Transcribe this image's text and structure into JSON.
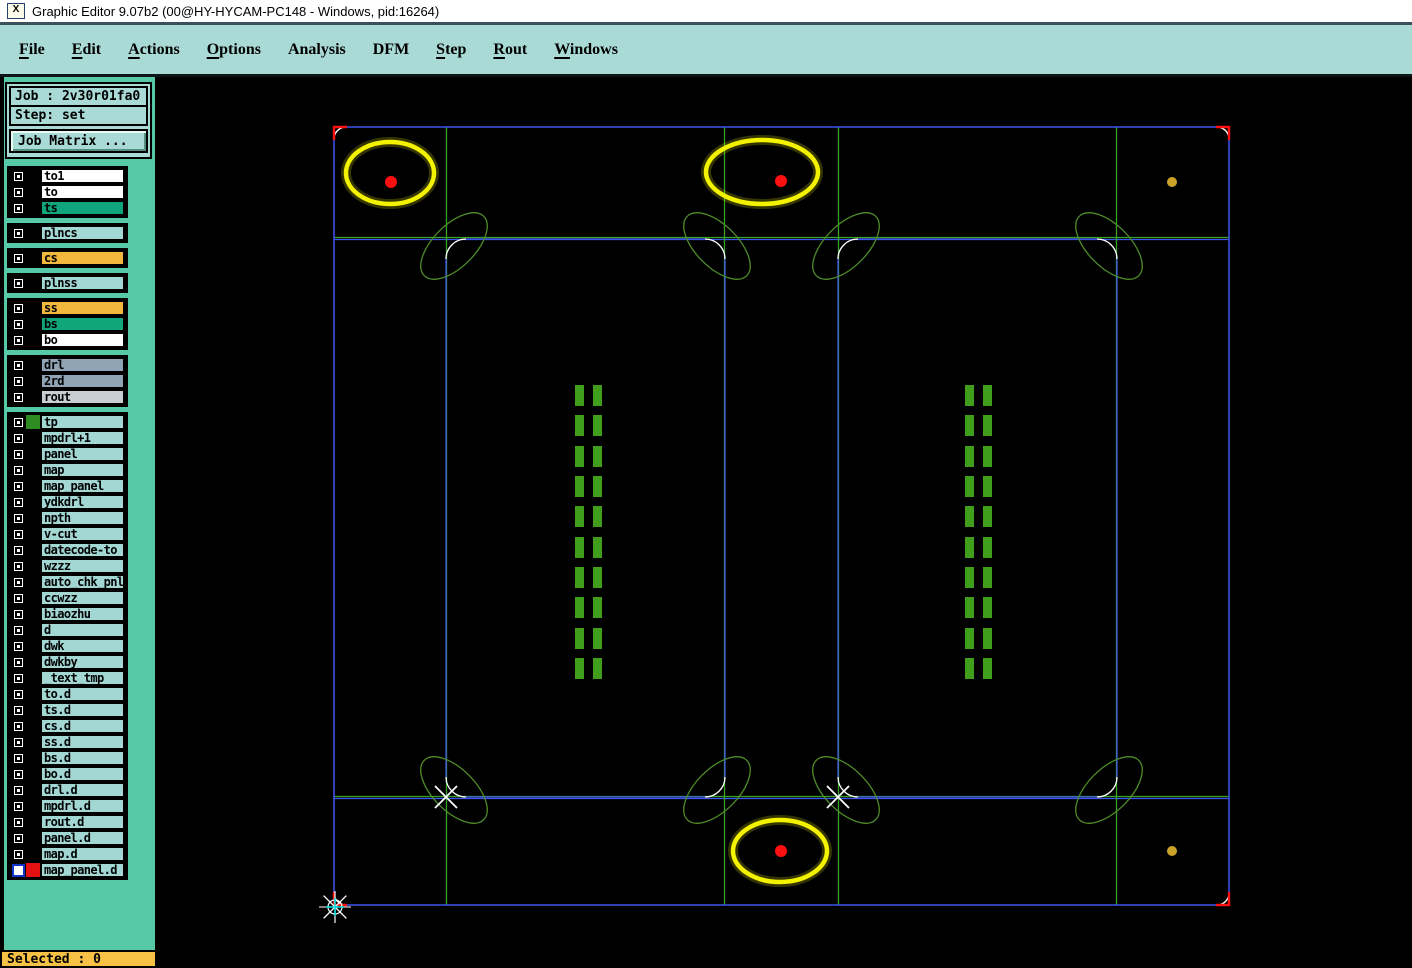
{
  "window": {
    "title": "Graphic Editor 9.07b2 (00@HY-HYCAM-PC148 - Windows, pid:16264)",
    "icon_glyph": "X"
  },
  "menu": {
    "items": [
      {
        "label": "File",
        "underline": 0
      },
      {
        "label": "Edit",
        "underline": 0
      },
      {
        "label": "Actions",
        "underline": 0
      },
      {
        "label": "Options",
        "underline": 0
      },
      {
        "label": "Analysis",
        "underline": -1
      },
      {
        "label": "DFM",
        "underline": -1
      },
      {
        "label": "Step",
        "underline": 0
      },
      {
        "label": "Rout",
        "underline": 0
      },
      {
        "label": "Windows",
        "underline": 0
      }
    ]
  },
  "sidebar": {
    "job_label": "Job : 2v30r01fa0",
    "step_label": "Step: set",
    "job_matrix_button": "Job Matrix ...",
    "selected_status": "Selected : 0",
    "row_colors": {
      "white": "#ffffff",
      "green": "#10a57b",
      "orange": "#f2b83e",
      "pale": "#a2d7d3",
      "gray": "#8fa3b5",
      "lightgray": "#c9ced2"
    },
    "layer_groups": [
      [
        {
          "label": "to1",
          "bg": "#ffffff"
        },
        {
          "label": "to",
          "bg": "#ffffff"
        },
        {
          "label": "ts",
          "bg": "#10a57b"
        }
      ],
      [
        {
          "label": "plncs",
          "bg": "#a2d7d3"
        }
      ],
      [
        {
          "label": "cs",
          "bg": "#f2b83e"
        }
      ],
      [
        {
          "label": "plnss",
          "bg": "#a2d7d3"
        }
      ],
      [
        {
          "label": "ss",
          "bg": "#f2b83e"
        },
        {
          "label": "bs",
          "bg": "#10a57b"
        },
        {
          "label": "bo",
          "bg": "#ffffff"
        }
      ],
      [
        {
          "label": "drl",
          "bg": "#8fa3b5"
        },
        {
          "label": "2rd",
          "bg": "#8fa3b5"
        },
        {
          "label": "rout",
          "bg": "#c9ced2"
        }
      ],
      [
        {
          "label": "tp",
          "bg": "#a2d7d3",
          "swatch": "#2e8b22"
        },
        {
          "label": "mpdrl+1",
          "bg": "#a2d7d3"
        },
        {
          "label": "panel",
          "bg": "#a2d7d3"
        },
        {
          "label": "map",
          "bg": "#a2d7d3"
        },
        {
          "label": "map_panel",
          "bg": "#a2d7d3"
        },
        {
          "label": "ydkdrl",
          "bg": "#a2d7d3"
        },
        {
          "label": "npth",
          "bg": "#a2d7d3"
        },
        {
          "label": "v-cut",
          "bg": "#a2d7d3"
        },
        {
          "label": "datecode-to",
          "bg": "#a2d7d3"
        },
        {
          "label": "wzzz",
          "bg": "#a2d7d3"
        },
        {
          "label": "auto_chk_pnl",
          "bg": "#a2d7d3"
        },
        {
          "label": "ccwzz",
          "bg": "#a2d7d3"
        },
        {
          "label": "biaozhu",
          "bg": "#a2d7d3"
        },
        {
          "label": "d",
          "bg": "#a2d7d3"
        },
        {
          "label": "dwk",
          "bg": "#a2d7d3"
        },
        {
          "label": "dwkby",
          "bg": "#a2d7d3"
        },
        {
          "label": "_text_tmp",
          "bg": "#a2d7d3"
        },
        {
          "label": "to.d",
          "bg": "#a2d7d3"
        },
        {
          "label": "ts.d",
          "bg": "#a2d7d3"
        },
        {
          "label": "cs.d",
          "bg": "#a2d7d3"
        },
        {
          "label": "ss.d",
          "bg": "#a2d7d3"
        },
        {
          "label": "bs.d",
          "bg": "#a2d7d3"
        },
        {
          "label": "bo.d",
          "bg": "#a2d7d3"
        },
        {
          "label": "drl.d",
          "bg": "#a2d7d3"
        },
        {
          "label": "mpdrl.d",
          "bg": "#a2d7d3"
        },
        {
          "label": "rout.d",
          "bg": "#a2d7d3"
        },
        {
          "label": "panel.d",
          "bg": "#a2d7d3"
        },
        {
          "label": "map.d",
          "bg": "#a2d7d3"
        },
        {
          "label": "map_panel.d",
          "bg": "#a2d7d3",
          "swatch": "#e81111",
          "checkbox_ring": "#1133cc"
        }
      ]
    ]
  },
  "canvas": {
    "background": "#000000",
    "colors": {
      "blue": "#4154ee",
      "green_line": "#37a327",
      "green_shape": "#4e8c28",
      "green_bar": "#3f9e1c",
      "yellow": "#f2f201",
      "red": "#ff1010",
      "gold": "#c9a227",
      "white": "#ffffff",
      "cyan": "#00e5e5"
    },
    "outer_rect": {
      "x1": 334,
      "y1": 127,
      "x2": 1229,
      "y2": 905,
      "corner_radius": 12
    },
    "inner_rects": [
      {
        "x1": 446,
        "y1": 239,
        "x2": 725,
        "y2": 797
      },
      {
        "x1": 838,
        "y1": 239,
        "x2": 1117,
        "y2": 797
      }
    ],
    "inner_corner_radius": 20,
    "green_vertical_lines": [
      446.5,
      724.5,
      838.5,
      1116.5
    ],
    "green_horizontal_lines": [
      237.5,
      796.5
    ],
    "blue_horizontal_lines": [
      239.5,
      798.5
    ],
    "target_ellipses": [
      {
        "cx": 390,
        "cy": 173,
        "rx": 44,
        "ry": 31,
        "dot_x": 391,
        "dot_y": 182
      },
      {
        "cx": 762,
        "cy": 172,
        "rx": 56,
        "ry": 32,
        "dot_x": 781,
        "dot_y": 181
      },
      {
        "cx": 780,
        "cy": 851,
        "rx": 47,
        "ry": 31,
        "dot_x": 781,
        "dot_y": 851
      }
    ],
    "red_dot_radius": 6,
    "gold_dots": [
      {
        "cx": 1172,
        "cy": 182
      },
      {
        "cx": 1172,
        "cy": 851
      }
    ],
    "gold_dot_radius": 5,
    "x_marks": [
      {
        "cx": 446,
        "cy": 797
      },
      {
        "cx": 838,
        "cy": 797
      }
    ],
    "origin_marker": {
      "cx": 335,
      "cy": 907
    },
    "bar_groups": [
      {
        "col_x": [
          575,
          593
        ]
      },
      {
        "col_x": [
          965,
          983
        ]
      }
    ],
    "bar": {
      "width": 9,
      "height": 21,
      "row_ys": [
        385,
        415,
        446,
        476,
        506,
        537,
        567,
        597,
        628,
        658
      ]
    }
  }
}
